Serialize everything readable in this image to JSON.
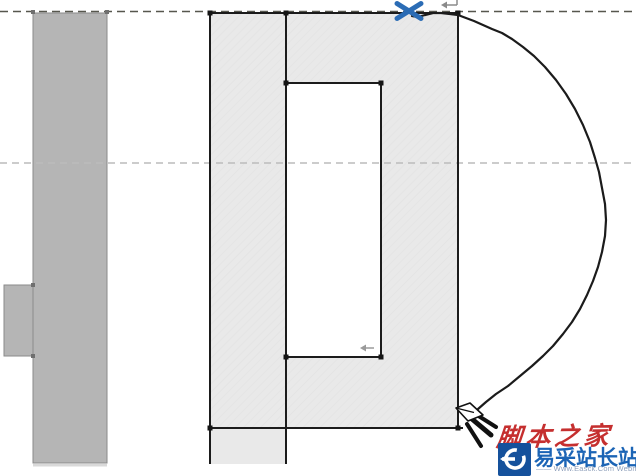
{
  "canvas": {
    "width": 636,
    "height": 476,
    "background": "#ffffff"
  },
  "drawing": {
    "reference_planes": [
      {
        "id": "top-reference-plane",
        "y": 11.5,
        "x1": 0,
        "x2": 636,
        "color": "#57574e",
        "dash": "8 5",
        "width": 1.6
      },
      {
        "id": "center-reference-plane",
        "y": 163,
        "x1": 0,
        "x2": 636,
        "color": "#bcbcbc",
        "dash": "7 5",
        "width": 1.6
      }
    ],
    "left_wall": {
      "fill": "#b5b5b5",
      "stroke": "#8a8a8a",
      "body": {
        "x": 33,
        "y": 13,
        "w": 74,
        "h": 450
      },
      "bump": {
        "x": 4,
        "y": 285,
        "w": 29,
        "h": 71
      },
      "handles": [
        [
          33,
          12
        ],
        [
          107,
          12
        ],
        [
          33,
          285
        ],
        [
          33,
          356
        ]
      ],
      "handle_color": "#6f6f6f",
      "shadow_color": "#c9c9c9"
    },
    "profile": {
      "fill": "#e9e9e9",
      "stroke": "#1b1b1b",
      "stroke_width": 2,
      "outer": {
        "x": 210,
        "y": 13,
        "w": 248,
        "h": 415
      },
      "extension": {
        "x": 210,
        "y": 428,
        "w": 76,
        "h": 36
      },
      "opening": {
        "x": 286,
        "y": 83,
        "w": 95,
        "h": 274,
        "fill": "#ffffff"
      },
      "outline_lines": [
        [
          209,
          13,
          459,
          13
        ],
        [
          210,
          12,
          210,
          464
        ],
        [
          458,
          12,
          458,
          429
        ],
        [
          208,
          428,
          463,
          428
        ],
        [
          286,
          13,
          286,
          464
        ]
      ],
      "vertices": [
        [
          210,
          13
        ],
        [
          286,
          13
        ],
        [
          458,
          13
        ],
        [
          286,
          83
        ],
        [
          381,
          83
        ],
        [
          286,
          357
        ],
        [
          381,
          357
        ],
        [
          210,
          428
        ],
        [
          458,
          428
        ]
      ],
      "vertex_color": "#151515"
    },
    "freehand_curve": {
      "color": "#1b1b1b",
      "width": 2.2,
      "points": [
        [
          412,
          16
        ],
        [
          418,
          17
        ],
        [
          425,
          15
        ],
        [
          433,
          13
        ],
        [
          441,
          13
        ],
        [
          450,
          14
        ],
        [
          458,
          15
        ],
        [
          466,
          18
        ],
        [
          474,
          21
        ],
        [
          483,
          25
        ],
        [
          492,
          29
        ],
        [
          502,
          33
        ],
        [
          512,
          39
        ],
        [
          523,
          47
        ],
        [
          534,
          56
        ],
        [
          545,
          67
        ],
        [
          556,
          80
        ],
        [
          566,
          94
        ],
        [
          575,
          109
        ],
        [
          583,
          125
        ],
        [
          590,
          142
        ],
        [
          595,
          158
        ],
        [
          599,
          172
        ],
        [
          602,
          188
        ],
        [
          605,
          204
        ],
        [
          606,
          220
        ],
        [
          605,
          236
        ],
        [
          602,
          252
        ],
        [
          598,
          267
        ],
        [
          593,
          281
        ],
        [
          587,
          295
        ],
        [
          580,
          309
        ],
        [
          572,
          322
        ],
        [
          563,
          334
        ],
        [
          553,
          346
        ],
        [
          543,
          356
        ],
        [
          532,
          366
        ],
        [
          520,
          376
        ],
        [
          508,
          386
        ],
        [
          496,
          394
        ],
        [
          486,
          402
        ],
        [
          478,
          409
        ],
        [
          476,
          413
        ]
      ]
    },
    "cursor_x": {
      "cx": 409,
      "cy": 11,
      "arm": 12,
      "color": "#2b6cb5",
      "width": 5
    },
    "flip_arrows": [
      {
        "tip_x": 441,
        "tip_y": 5,
        "len": 16,
        "color": "#8a8a8a",
        "tick": true
      },
      {
        "tip_x": 360,
        "tip_y": 348,
        "len": 14,
        "color": "#9a9a9a",
        "tick": false
      }
    ],
    "pencil": {
      "tip_x": 456,
      "tip_y": 408,
      "outline": "#111111",
      "fill": "#ffffff"
    }
  },
  "watermark": {
    "site_name_calligraphy": "脚本之家",
    "site_name": "易采站长站",
    "tagline": "—— Www.Easck.Com Webmaster",
    "colors": {
      "red": "#c52f2f",
      "blue": "#1b64b5",
      "logo_bg": "#15519c",
      "tagline_gray": "#8fa0bb"
    }
  },
  "icons": {
    "blue_x_cursor": "sketch-endpoint-x",
    "pencil_cursor": "draw-pencil",
    "flip_arrow": "flip-control-arrow",
    "logo_glyph": "easck-e-logo"
  }
}
